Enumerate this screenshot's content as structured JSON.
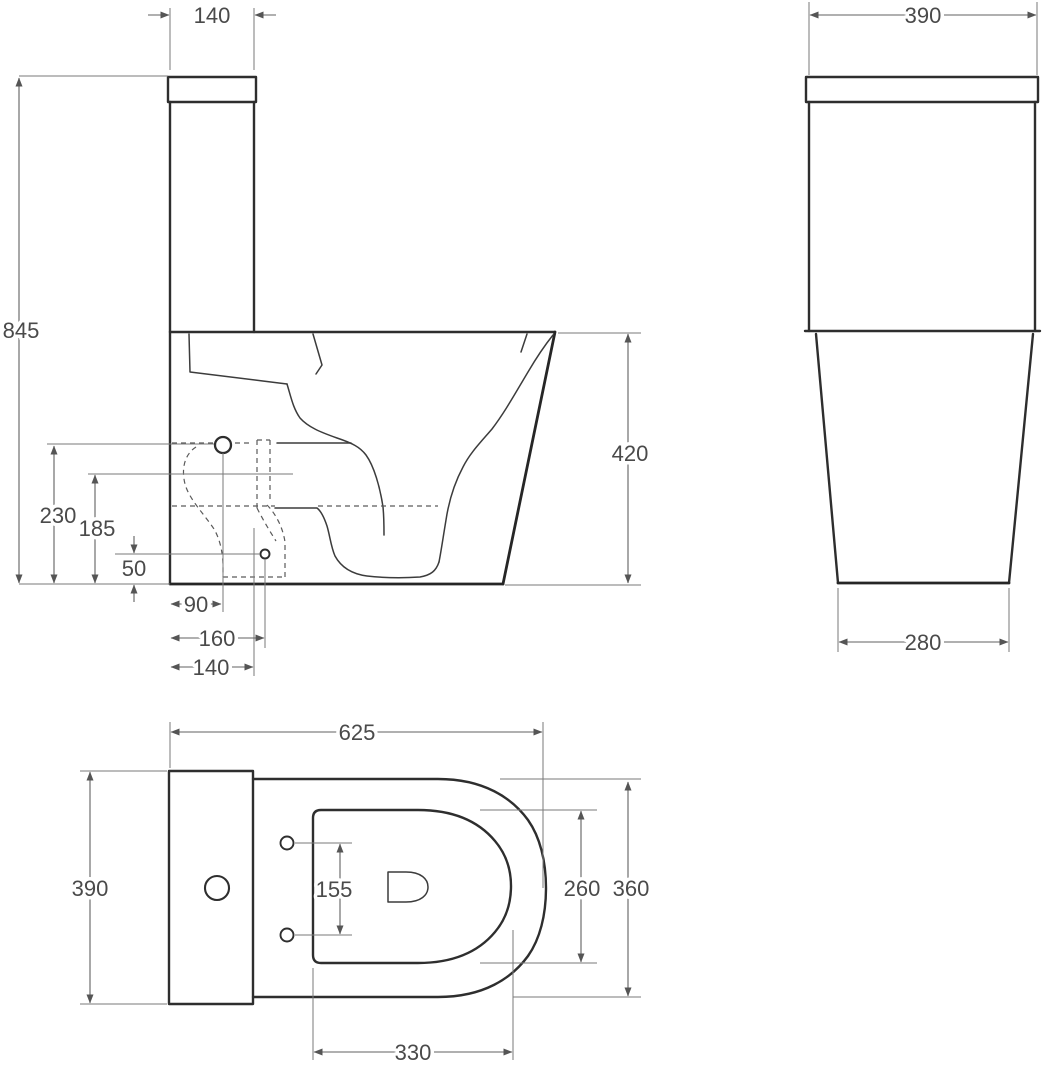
{
  "drawing": {
    "title": "toilet-technical-drawing-three-views",
    "views": {
      "side": {
        "tank_width_top": "140",
        "total_height": "845",
        "bowl_height": "420",
        "trap_center_height": "230",
        "outlet_height": "185",
        "inlet_height": "50",
        "offset_90": "90",
        "offset_160": "160",
        "offset_140": "140"
      },
      "front": {
        "tank_width": "390",
        "base_width": "280"
      },
      "top": {
        "total_length": "625",
        "tank_width": "390",
        "seat_hole_spacing": "155",
        "inner_width": "260",
        "bowl_width": "360",
        "inner_length": "330"
      }
    },
    "colors": {
      "outline": "#2e2e2e",
      "dimension_lines": "#616161",
      "hidden_lines": "#5a5a5a",
      "text": "#4a4a4a",
      "background": "#ffffff"
    }
  }
}
